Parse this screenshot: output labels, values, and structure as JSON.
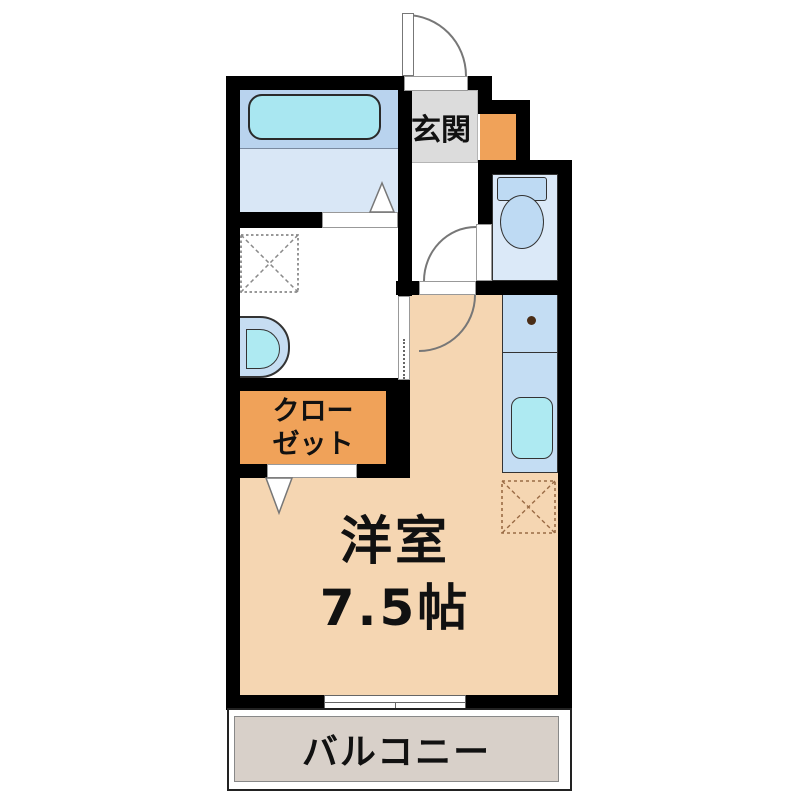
{
  "floor_plan": {
    "kind": "japanese-apartment-floor-plan",
    "labels": {
      "entrance": "玄関",
      "closet_line1": "クロー",
      "closet_line2": "ゼット",
      "main_room": "洋室",
      "main_room_size": "7.5帖",
      "balcony": "バルコニー"
    },
    "fixtures": [
      "entrance-door",
      "bathtub",
      "bathroom-folding-door",
      "washing-machine-space",
      "wash-basin",
      "sliding-door",
      "closet-folding-door",
      "toilet-tank",
      "toilet-bowl",
      "toilet-door",
      "room-door",
      "stove-burner",
      "kitchen-sink",
      "refrigerator-space",
      "sliding-window"
    ],
    "colors": {
      "wall": "#000000",
      "main_room_floor": "#f5d6b2",
      "balcony_floor": "#d8d0c9",
      "entrance_floor": "#dcdcdc",
      "closet_fill": "#f0a259",
      "shoe_cabinet_fill": "#f0a259",
      "bathroom_upper": "#b9d3ee",
      "bathroom_lower": "#d9e7f6",
      "bathtub": "#a9e7f1",
      "toilet_room": "#dbe9f8",
      "fixture_blue": "#bedaf3",
      "kitchen_counter": "#c4ddf3",
      "sink_cyan": "#aeeaf2",
      "basin_outer": "#c6ddf2",
      "burner_dot": "#4a2d16"
    }
  }
}
